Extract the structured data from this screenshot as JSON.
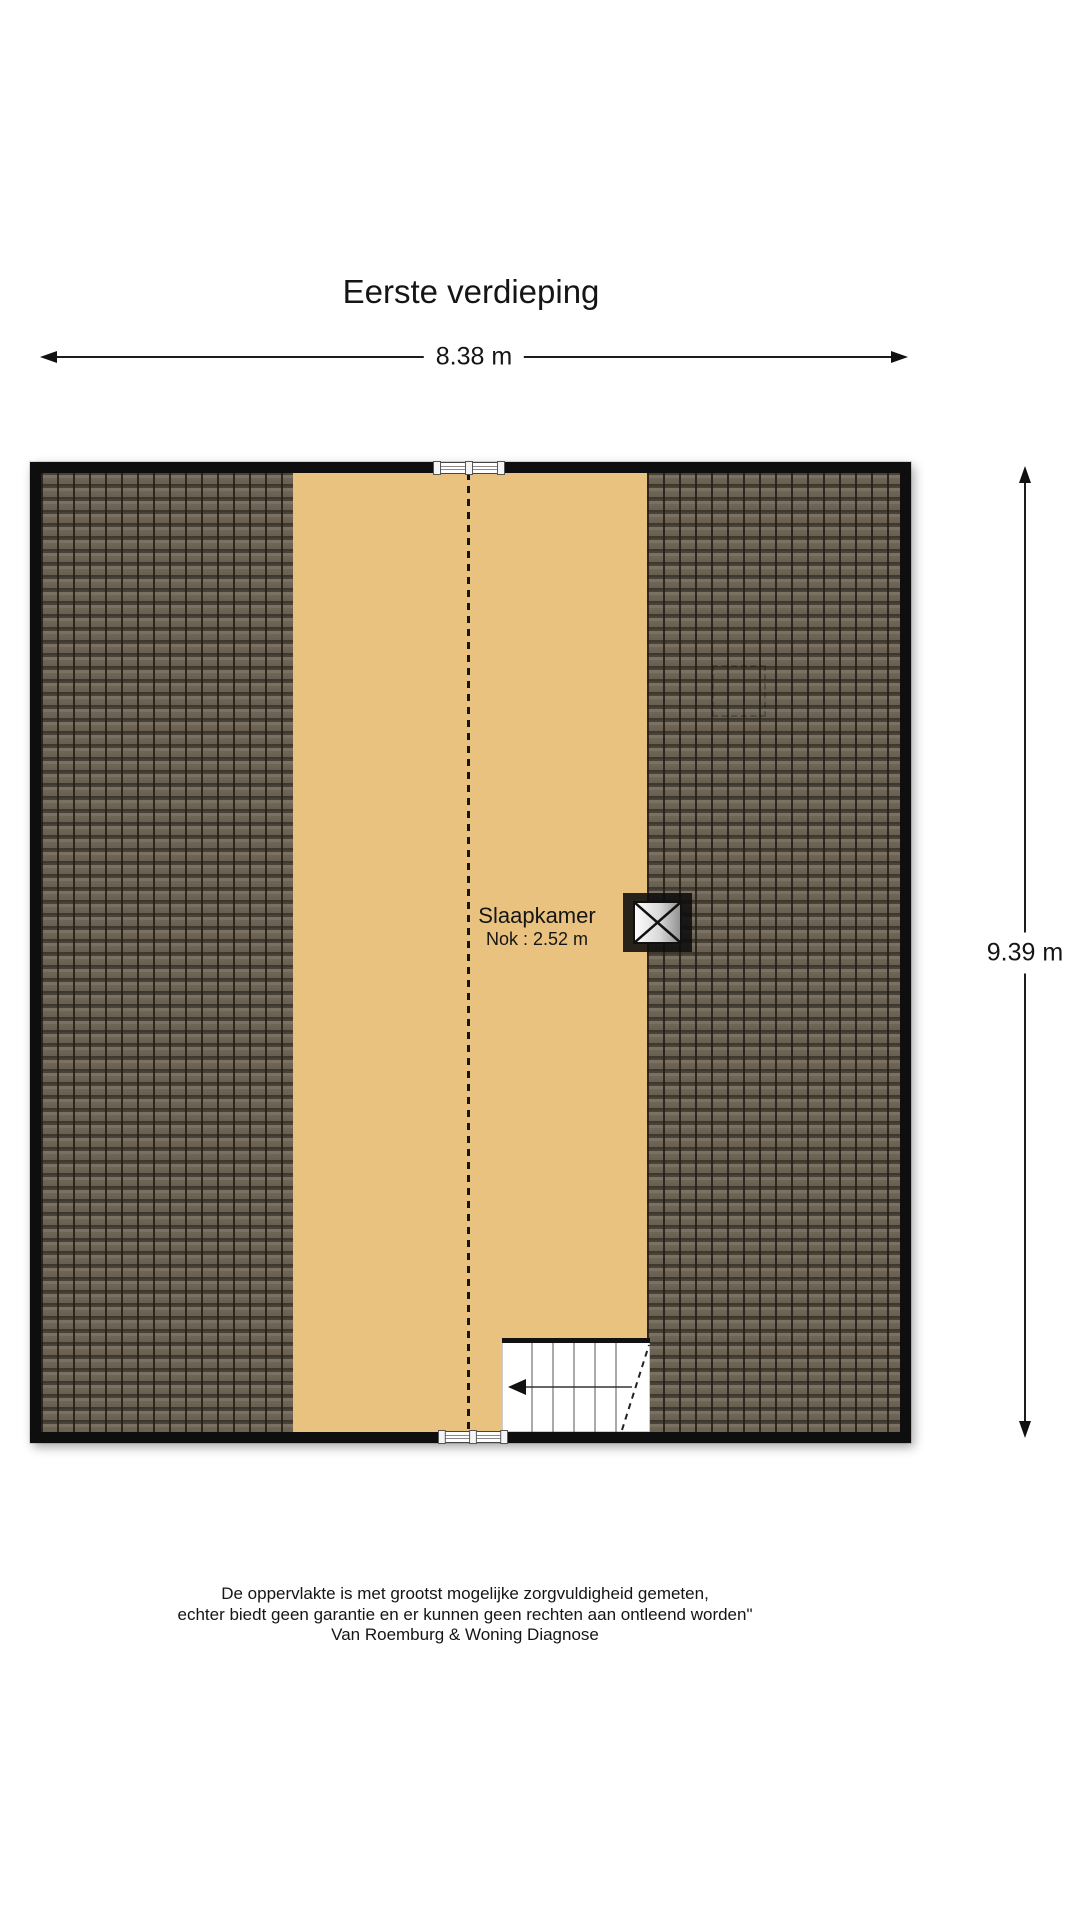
{
  "page": {
    "title": "Eerste verdieping"
  },
  "dimensions": {
    "width": "8.38 m",
    "height": "9.39 m"
  },
  "room": {
    "name": "Slaapkamer",
    "ridge_height": "Nok : 2.52 m"
  },
  "footer": {
    "line1": "De oppervlakte is met grootst mogelijke zorgvuldigheid gemeten,",
    "line2": "echter biedt geen garantie en er kunnen geen rechten aan ontleend worden\"",
    "line3": "Van Roemburg & Woning Diagnose"
  },
  "colors": {
    "floor": "#e9c27f",
    "tile": "#6f6658",
    "tile_joint": "#3e382e",
    "wall": "#0e0e0e",
    "accent_text": "#151515"
  }
}
